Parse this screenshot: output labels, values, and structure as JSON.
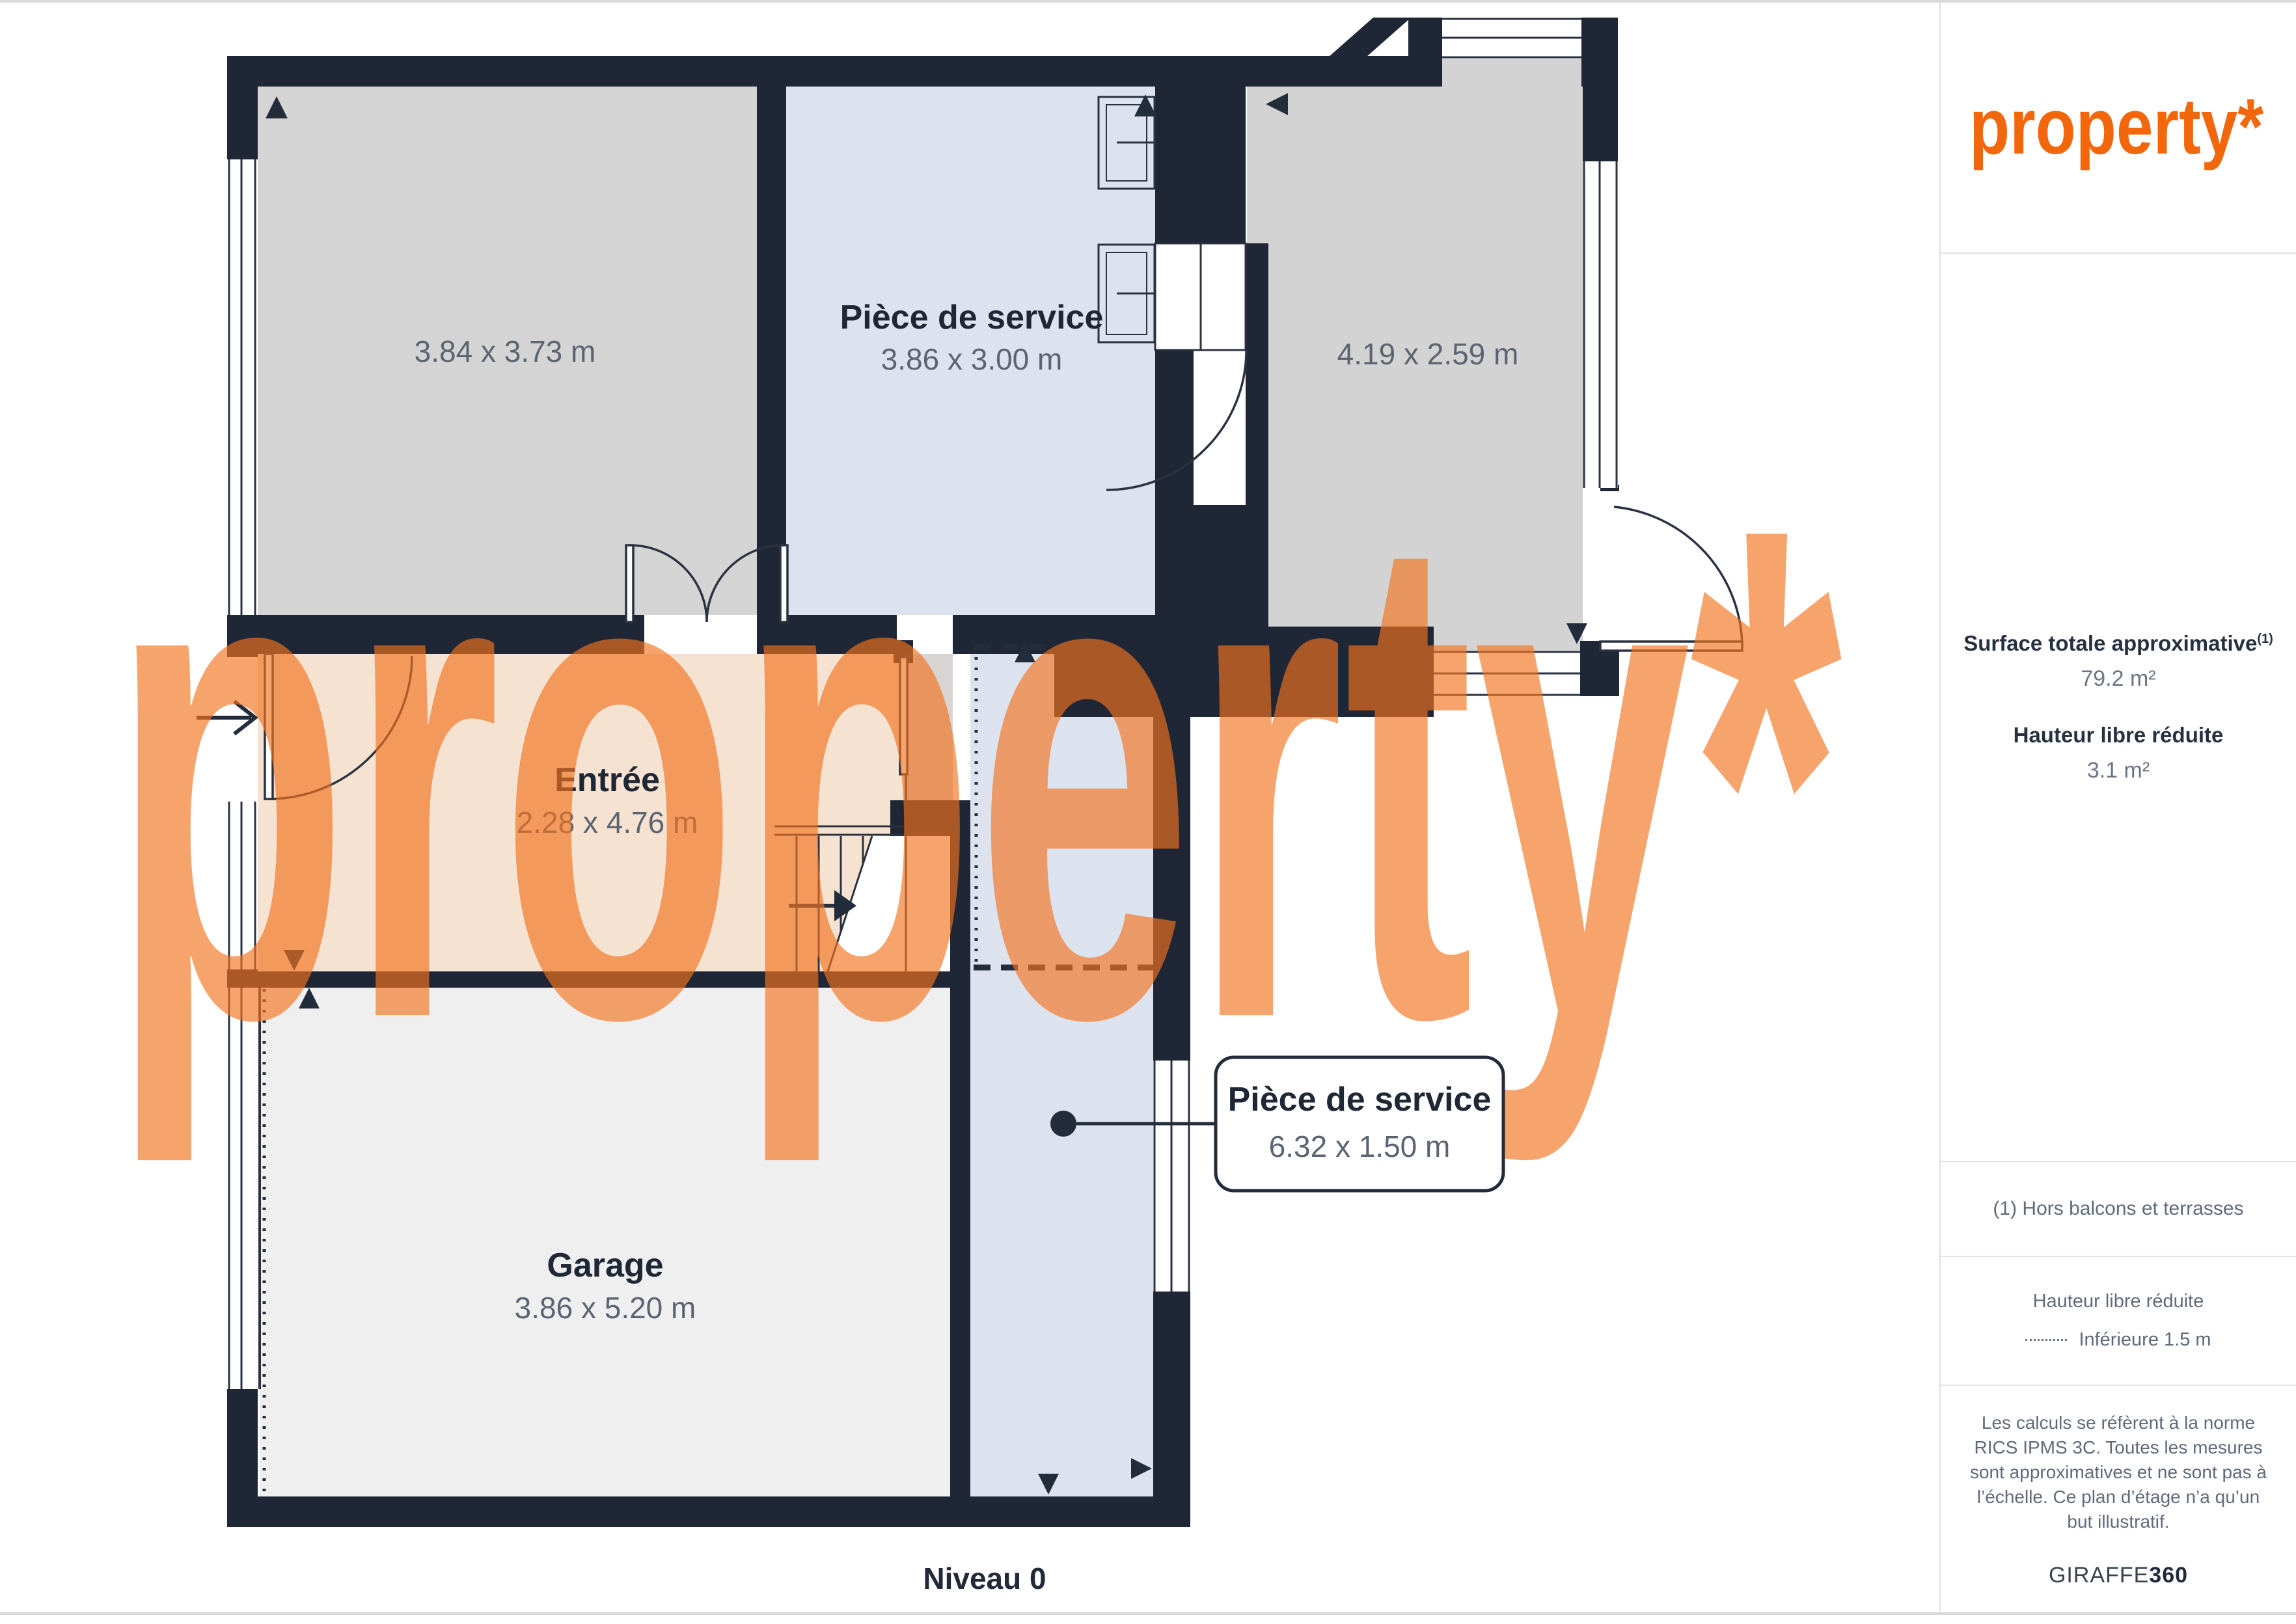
{
  "page": {
    "level_label": "Niveau 0"
  },
  "brand": {
    "logo_text": "property*",
    "watermark_text": "property*"
  },
  "plan": {
    "rooms": [
      {
        "name": "",
        "dims": "3.84 x 3.73 m"
      },
      {
        "name": "Pièce de service",
        "dims": "3.86 x 3.00 m"
      },
      {
        "name": "",
        "dims": "4.19 x 2.59 m"
      },
      {
        "name": "Entrée",
        "dims": "2.28 x 4.76 m"
      },
      {
        "name": "Garage",
        "dims": "3.86 x 5.20 m"
      }
    ],
    "callout": {
      "name": "Pièce de service",
      "dims": "6.32 x 1.50 m"
    }
  },
  "sidebar": {
    "surface_label": "Surface totale approximative",
    "surface_footnote_marker": "(1)",
    "surface_value": "79.2 m²",
    "reduced_height_label": "Hauteur libre réduite",
    "reduced_height_value": "3.1 m²",
    "footnote": "(1) Hors balcons et terrasses",
    "legend_title": "Hauteur libre réduite",
    "legend_item": "Inférieure 1.5 m",
    "disclaimer": "Les calculs se réfèrent à la norme RICS IPMS 3C. Toutes les mesures sont approximatives et ne sont pas à l’échelle. Ce plan d’étage n’a qu’un but illustratif.",
    "brand_name": "GIRAFFE",
    "brand_suffix": "360"
  },
  "colors": {
    "accent": "#f2670c",
    "watermark": "#f4731f",
    "wall": "#1f2736"
  }
}
